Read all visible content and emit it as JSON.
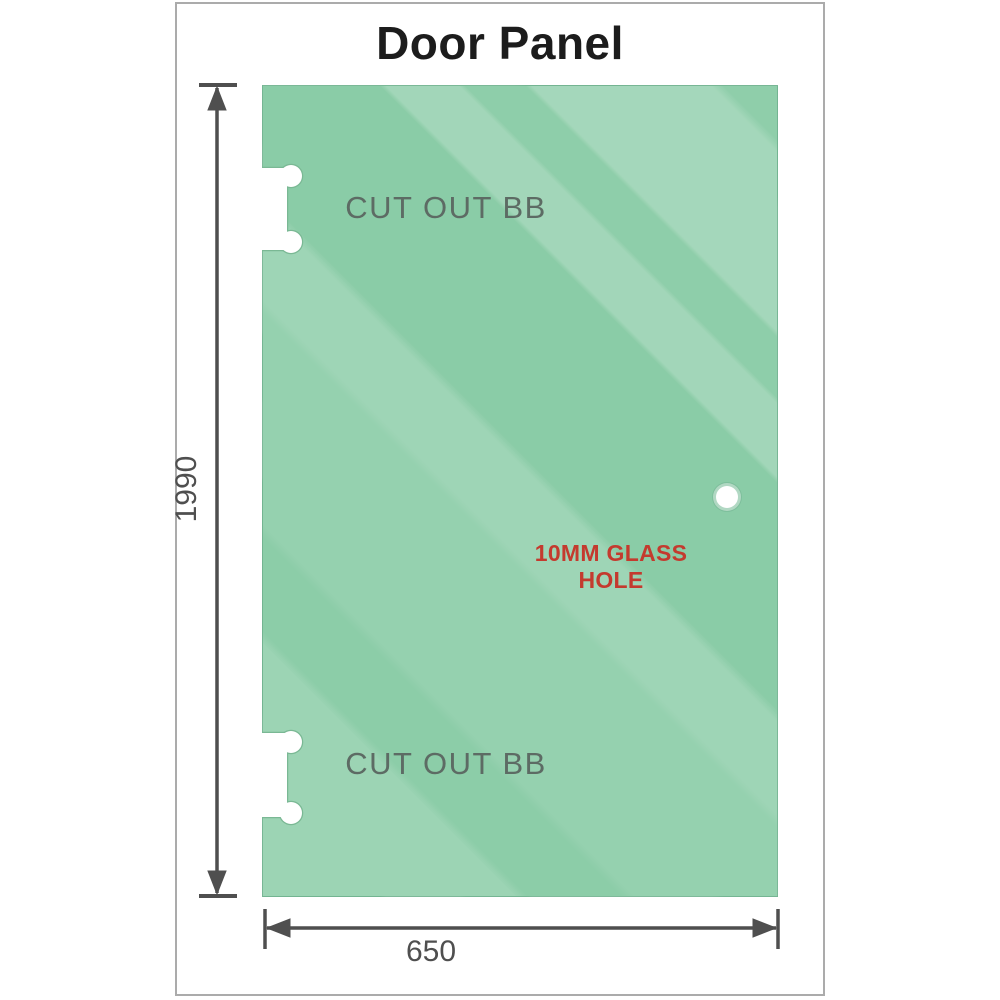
{
  "title": "Door Panel",
  "panel": {
    "cutout_top": {
      "label": "CUT OUT BB"
    },
    "cutout_bottom": {
      "label": "CUT OUT BB"
    },
    "hole": {
      "label": "10MM GLASS HOLE"
    }
  },
  "dimensions": {
    "height": "1990",
    "width": "650"
  },
  "colors": {
    "glass_green": "#88cba5",
    "hole_label_red": "#c43a2e",
    "dimension_gray": "#4f4f4f",
    "cutout_label_gray": "#5d6b64",
    "title_black": "#1c1c1c",
    "frame_gray": "#ababab"
  }
}
